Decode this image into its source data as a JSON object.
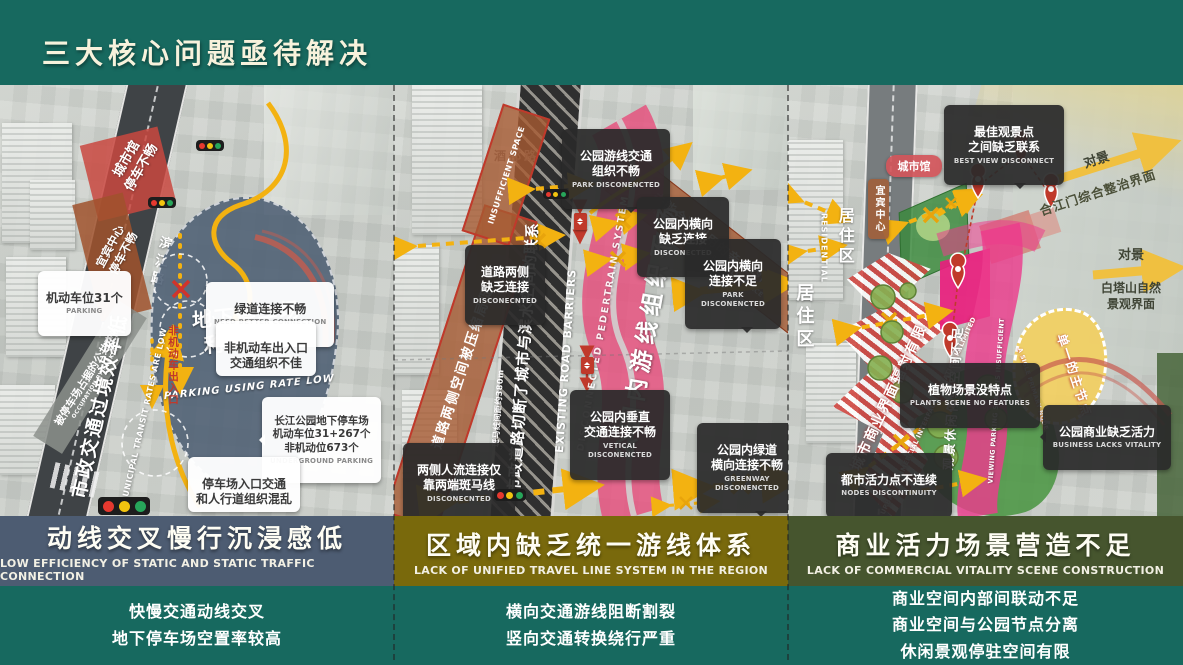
{
  "page": {
    "title": "三大核心问题亟待解决"
  },
  "colors": {
    "background_teal": "#17695f",
    "panel1_bar": "#4d5c72",
    "panel2_bar": "#79690c",
    "panel3_bar": "#46552e",
    "arrow_yellow": "#f3b211",
    "highlight_pink": "#e8488a",
    "warning_red": "#c0392b"
  },
  "panels": [
    {
      "bar": {
        "zh": "动线交叉慢行沉浸感低",
        "en": "LOW EFFICIENCY OF STATIC AND STATIC TRAFFIC CONNECTION",
        "color": "#4d5c72"
      },
      "summary": "快慢交通动线交叉\n地下停车场空置率较高",
      "map": {
        "road_name": "滨江路",
        "road_banner_zh": "市政交通过境效率低",
        "road_banner_en": "MUNICIPAL TRANSIT RATES ARE LOW",
        "parking_zone_zh": "地下停车场\n利用不佳",
        "parking_zone_en": "PARKING USING RATE LOW",
        "label_cityhall": "城市馆\n停车不畅",
        "label_center": "宜宾中心\n停车不畅",
        "band_occupation_zh": "被停车场占据的公共空间",
        "band_occupation_en": "OCCUPATION BY PARKING",
        "entrance_vertical": "非机动车出入口",
        "callout_parking_zh": "机动车位31个",
        "callout_parking_en": "PARKING",
        "callout_greenway_zh": "绿道连接不畅",
        "callout_greenway_en": "NEED BETTER CONNECTION",
        "callout_nonmotor": "非机动车出入口\n交通组织不佳",
        "callout_underground_zh": "长江公园地下停车场\n机动车位31+267个\n非机动位673个",
        "callout_underground_en": "UNDERGROUND PARKING",
        "callout_entrance": "停车场入口交通\n和人行道组织混乱"
      }
    },
    {
      "bar": {
        "zh": "区域内缺乏统一游线体系",
        "en": "LACK OF UNIFIED TRAVEL LINE SYSTEM IN THE REGION",
        "color": "#79690c"
      },
      "summary": "横向交通游线阻断割裂\n竖向交通转换绕行严重",
      "map": {
        "road_name": "酒都路",
        "road_banner_zh": "市政道路切断了城市与滨水空间的联系",
        "road_banner_en": "EXISTING ROAD BARRIERS",
        "crosswalk_note": "斑马线间距约380m",
        "band_left_zh": "道路两侧空间被压缩局促",
        "band_left_en": "INSUFFICIENT SPACE",
        "ribbon_zh": "公园内游线组织不畅",
        "ribbon_en": "DISCONNECTED PEDERTRAIN SYSTEM",
        "band_right_zh": "未能合理利用的亲水空间",
        "band_right_en": "UNREASONABLE HYDROPHILIC SPACE",
        "callouts": [
          {
            "zh": "公园游线交通\n组织不畅",
            "en": "PARK DISCONENCTED"
          },
          {
            "zh": "道路两侧\n缺乏连接",
            "en": "DISCONECNTED"
          },
          {
            "zh": "公园内横向\n缺乏连接",
            "en": "DISCONECTED"
          },
          {
            "zh": "公园内横向\n连接不足",
            "en": "PARK DISCONENCTED"
          },
          {
            "zh": "公园内垂直\n交通连接不畅",
            "en": "VETICAL DISCONENCTED"
          },
          {
            "zh": "两侧人流连接仅\n靠两端斑马线",
            "en": "DISCONECNTED"
          },
          {
            "zh": "公园内绿道\n横向连接不畅",
            "en": "GREENWAY\nDISCONENCTED"
          }
        ]
      }
    },
    {
      "bar": {
        "zh": "商业活力场景营造不足",
        "en": "LACK OF COMMERCIAL VITALITY SCENE CONSTRUCTION",
        "color": "#46552e"
      },
      "summary": "商业空间内部间联动不足\n商业空间与公园节点分离\n休闲景观停驻空间有限",
      "map": {
        "callout_bestview": {
          "zh": "最佳观景点\n之间缺乏联系",
          "en": "BEST VIEW DISCONNECT"
        },
        "callout_plants": {
          "zh": "植物场景没特点",
          "en": "PLANTS SCENE NO FEATURES"
        },
        "callout_business": {
          "zh": "公园商业缺乏活力",
          "en": "BUSINESS LACKS VITALITY"
        },
        "callout_nodes": {
          "zh": "都市活力点不连续",
          "en": "NODES DISCONTINUITY"
        },
        "tag_cityhall": "城市馆",
        "tag_center": "宜宾中心",
        "residential_zh": "居住区",
        "residential_en": "RESIDENTIAL",
        "residential2": "居住区",
        "band_stripe_zh": "城市商业界面辐射有限",
        "band_stripe_en": "URBAN COMMERCIAL INTERFACE RADIATION IS LIMITED",
        "ribbon_zh": "观景休闲停驻空间不足",
        "ribbon_en": "VIEWING PARKING SPACE IS INSUFFICIENT",
        "node_zh": "单一的主节点",
        "node_en": "A SIGLE PRIMARY NODE",
        "view1_label": "对景",
        "view1_target": "合江门综合整治界面",
        "view2_label": "对景",
        "view2_target": "白塔山自然\n景观界面"
      }
    }
  ]
}
